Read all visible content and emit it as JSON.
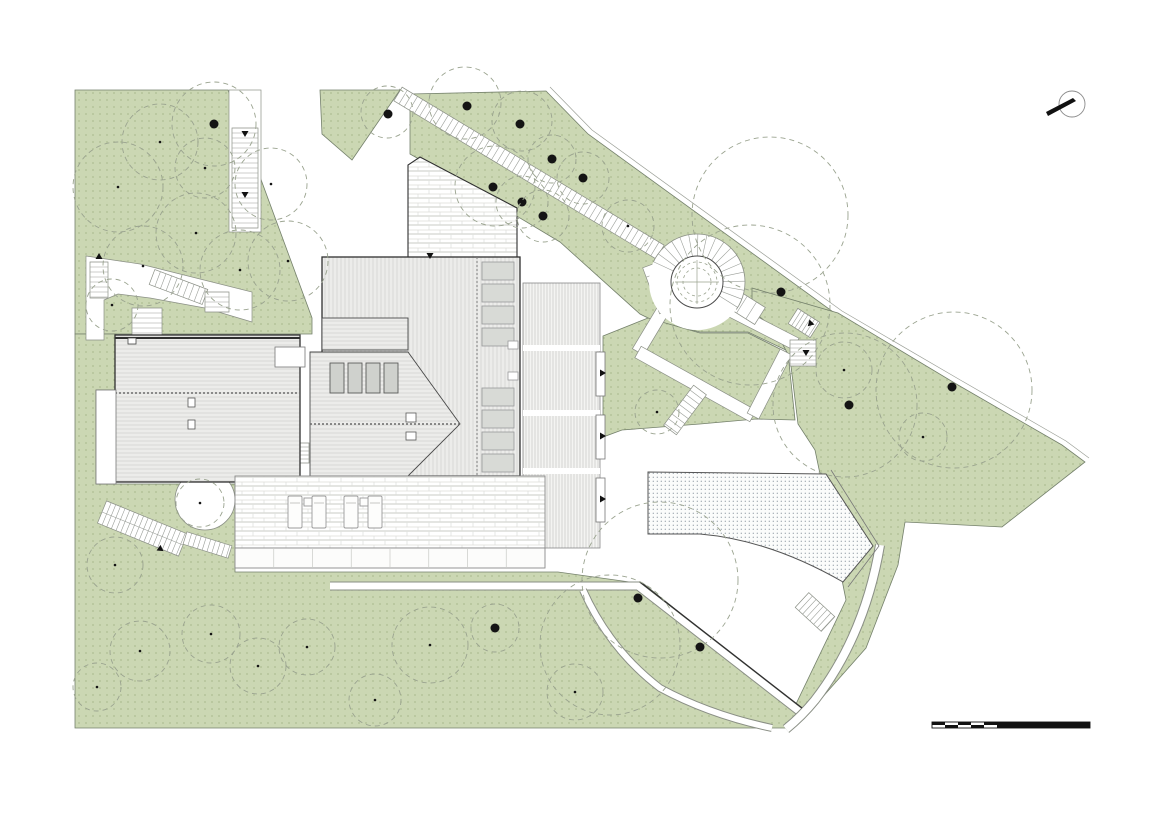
{
  "meta": {
    "drawing_type": "architectural-site-roof-plan",
    "visible_text": "none"
  },
  "canvas": {
    "width": 1160,
    "height": 821,
    "background": "#ffffff"
  },
  "colors": {
    "green_fill": "#cbd7b3",
    "green_dot": "#aebe93",
    "green_edge": "#74806b",
    "tree_dash": "#9aa38f",
    "trunk": "#141414",
    "roof_fill": "#ececea",
    "roof_line": "#d0d1cd",
    "outline_dark": "#2f2f2f",
    "skylight_fill": "#d8dad6",
    "skylight_edge": "#98989a",
    "brick_line": "#dcddd9",
    "path_edge": "#8a8f85",
    "tread": "#9a9e98",
    "stipple_dot": "#9aa3ac",
    "black": "#111111"
  },
  "north_arrow": {
    "cx": 1072,
    "cy": 104,
    "r": 13,
    "needle": [
      [
        1048,
        116
      ],
      [
        1076,
        101
      ],
      [
        1073,
        98
      ],
      [
        1046,
        112
      ]
    ]
  },
  "scale_bar": {
    "x": 932,
    "y": 722,
    "h": 6,
    "cell_w": 13,
    "cells": 5,
    "solid_w": 93
  },
  "greens": [
    [
      [
        75,
        90
      ],
      [
        228,
        90
      ],
      [
        312,
        318
      ],
      [
        312,
        334
      ],
      [
        96,
        334
      ],
      [
        75,
        334
      ]
    ],
    [
      [
        320,
        90
      ],
      [
        400,
        90
      ],
      [
        352,
        160
      ],
      [
        322,
        134
      ]
    ],
    [
      [
        410,
        94
      ],
      [
        546,
        91
      ],
      [
        588,
        134
      ],
      [
        836,
        314
      ],
      [
        814,
        332
      ],
      [
        790,
        352
      ],
      [
        748,
        332
      ],
      [
        700,
        332
      ],
      [
        652,
        320
      ],
      [
        640,
        314
      ],
      [
        560,
        242
      ],
      [
        470,
        188
      ],
      [
        410,
        154
      ]
    ],
    [
      [
        603,
        336
      ],
      [
        648,
        318
      ],
      [
        700,
        333
      ],
      [
        748,
        333
      ],
      [
        788,
        353
      ],
      [
        795,
        420
      ],
      [
        756,
        419
      ],
      [
        700,
        424
      ],
      [
        622,
        430
      ],
      [
        603,
        437
      ]
    ],
    [
      [
        752,
        288
      ],
      [
        838,
        313
      ],
      [
        958,
        385
      ],
      [
        1062,
        445
      ],
      [
        1085,
        462
      ],
      [
        1002,
        527
      ],
      [
        905,
        522
      ],
      [
        898,
        565
      ],
      [
        866,
        648
      ],
      [
        820,
        700
      ],
      [
        806,
        712
      ],
      [
        796,
        704
      ],
      [
        846,
        600
      ],
      [
        838,
        560
      ],
      [
        815,
        450
      ],
      [
        798,
        424
      ],
      [
        790,
        358
      ],
      [
        775,
        330
      ],
      [
        752,
        310
      ]
    ],
    [
      [
        75,
        334
      ],
      [
        116,
        334
      ],
      [
        116,
        390
      ],
      [
        96,
        390
      ],
      [
        96,
        484
      ],
      [
        116,
        484
      ],
      [
        235,
        484
      ],
      [
        235,
        572
      ],
      [
        558,
        572
      ],
      [
        644,
        584
      ],
      [
        806,
        714
      ],
      [
        788,
        728
      ],
      [
        75,
        728
      ]
    ]
  ],
  "boundary_offset_line": [
    [
      550,
      87
    ],
    [
      592,
      130
    ],
    [
      842,
      311
    ],
    [
      962,
      381
    ],
    [
      1066,
      441
    ],
    [
      1089,
      458
    ]
  ],
  "white_shapes": {
    "corridor_top": [
      229,
      90,
      32,
      142
    ],
    "winding_path": [
      [
        86,
        256
      ],
      [
        140,
        264
      ],
      [
        252,
        292
      ],
      [
        252,
        322
      ],
      [
        205,
        308
      ],
      [
        150,
        298
      ],
      [
        118,
        294
      ],
      [
        104,
        300
      ],
      [
        104,
        340
      ],
      [
        86,
        340
      ]
    ],
    "plaza_circle": [
      205,
      500,
      30
    ],
    "terrace_left_strip": [
      96,
      390,
      20,
      94
    ],
    "annex": [
      275,
      347,
      30,
      20
    ]
  },
  "corridor_bands": [
    {
      "a": [
        668,
        302
      ],
      "b": [
        638,
        352
      ],
      "w": 13
    },
    {
      "a": [
        638,
        352
      ],
      "b": [
        753,
        416
      ],
      "w": 13
    },
    {
      "a": [
        753,
        416
      ],
      "b": [
        786,
        352
      ],
      "w": 13
    },
    {
      "a": [
        718,
        304
      ],
      "b": [
        796,
        344
      ],
      "w": 13
    }
  ],
  "stairs": [
    {
      "a": [
        245,
        128
      ],
      "b": [
        245,
        228
      ],
      "w": 26,
      "step": 5
    },
    {
      "a": [
        99,
        262
      ],
      "b": [
        99,
        298
      ],
      "w": 18,
      "step": 5
    },
    {
      "a": [
        152,
        277
      ],
      "b": [
        205,
        297
      ],
      "w": 16,
      "step": 6
    },
    {
      "a": [
        147,
        308
      ],
      "b": [
        147,
        336
      ],
      "w": 30,
      "step": 5
    },
    {
      "a": [
        217,
        292
      ],
      "b": [
        217,
        312
      ],
      "w": 24,
      "step": 5
    },
    {
      "a": [
        102,
        512
      ],
      "b": [
        183,
        545
      ],
      "w": 24,
      "step": 5,
      "rail": true
    },
    {
      "a": [
        185,
        538
      ],
      "b": [
        230,
        552
      ],
      "w": 13,
      "step": 5
    },
    {
      "a": [
        653,
        264
      ],
      "b": [
        670,
        310
      ],
      "w": 22,
      "step": 10
    },
    {
      "a": [
        714,
        287
      ],
      "b": [
        760,
        316
      ],
      "w": 20,
      "step": 11
    },
    {
      "a": [
        793,
        316
      ],
      "b": [
        815,
        330
      ],
      "w": 18,
      "step": 4
    },
    {
      "a": [
        803,
        340
      ],
      "b": [
        803,
        366
      ],
      "w": 26,
      "step": 4
    },
    {
      "a": [
        802,
        600
      ],
      "b": [
        828,
        624
      ],
      "w": 20,
      "step": 5
    },
    {
      "a": [
        700,
        390
      ],
      "b": [
        670,
        430
      ],
      "w": 16,
      "step": 6
    },
    {
      "a": [
        398,
        94
      ],
      "b": [
        660,
        252
      ],
      "w": 16,
      "step": 6
    },
    {
      "a": [
        302,
        443
      ],
      "b": [
        302,
        463
      ],
      "w": 14,
      "step": 4
    }
  ],
  "routes": [
    {
      "d": "M330,586 L638,586 L800,712",
      "w": 7
    },
    {
      "d": "M583,590 Q610,650 660,688 Q710,715 772,728",
      "w": 6
    },
    {
      "d": "M880,545 Q865,635 815,700 Q802,716 786,729",
      "w": 8
    }
  ],
  "route_dark_edge": "M640,582 L802,708",
  "spiral_stair": {
    "cx": 697,
    "cy": 282,
    "r_plaza": 48,
    "r_outer": 26,
    "r_dashed": [
      20,
      14
    ],
    "fan": {
      "r1": 26,
      "r2": 48,
      "a1": -155,
      "a2": 35,
      "step": 11
    }
  },
  "buildings": {
    "left": {
      "rect": [
        115,
        335,
        185,
        147
      ],
      "ridge_y": 393,
      "chimney": [
        128,
        338,
        8,
        6
      ],
      "vents": [
        [
          188,
          398,
          7,
          9
        ],
        [
          188,
          420,
          7,
          9
        ]
      ]
    },
    "main_roof": {
      "rect": [
        322,
        257,
        198,
        219
      ],
      "divider_x": 477
    },
    "courtyard": [
      [
        408,
        257
      ],
      [
        408,
        165
      ],
      [
        420,
        157
      ],
      [
        517,
        208
      ],
      [
        517,
        257
      ]
    ],
    "skylights": {
      "x": 482,
      "w": 32,
      "h": 18,
      "ys": [
        262,
        284,
        306,
        328,
        388,
        410,
        432,
        454
      ],
      "small": [
        [
          508,
          341,
          10,
          8
        ],
        [
          508,
          372,
          10,
          8
        ]
      ]
    },
    "wing": [
      322,
      318,
      86,
      32
    ],
    "hip": {
      "poly": [
        [
          310,
          352
        ],
        [
          408,
          352
        ],
        [
          460,
          424
        ],
        [
          408,
          476
        ],
        [
          310,
          476
        ]
      ],
      "ridge": [
        310,
        424,
        460,
        424
      ],
      "windows": {
        "xs": [
          330,
          348,
          366,
          384
        ],
        "y": 363,
        "w": 14,
        "h": 30
      },
      "vents": [
        [
          406,
          413,
          10,
          9
        ],
        [
          406,
          432,
          10,
          8
        ]
      ]
    },
    "striped_zone": {
      "rect": [
        523,
        283,
        77,
        265
      ],
      "gaps": [
        345,
        410,
        468
      ],
      "doors": [
        [
          596,
          352,
          9,
          44
        ],
        [
          596,
          415,
          9,
          44
        ],
        [
          596,
          478,
          9,
          44
        ]
      ]
    },
    "terrace": {
      "rect": [
        235,
        476,
        310,
        72
      ],
      "loungers": [
        [
          288,
          496
        ],
        [
          312,
          496
        ],
        [
          344,
          496
        ],
        [
          368,
          496
        ]
      ],
      "lounger_size": [
        14,
        32
      ],
      "tables": [
        [
          304,
          498
        ],
        [
          360,
          498
        ]
      ],
      "step_band": {
        "y": 548,
        "h": 20,
        "cols": 8
      }
    }
  },
  "pool": {
    "outline": "M648,472 L826,474 L873,546 L843,582 Q770,540 700,534 L648,534 Z",
    "deck_edge": "M831,470 L879,546 L848,587"
  },
  "trees": [
    [
      118,
      187,
      45,
      "s"
    ],
    [
      160,
      142,
      38,
      "s"
    ],
    [
      214,
      124,
      42,
      "b"
    ],
    [
      205,
      168,
      30,
      "s"
    ],
    [
      271,
      184,
      36,
      "s"
    ],
    [
      288,
      261,
      40,
      "s"
    ],
    [
      196,
      233,
      40,
      "s"
    ],
    [
      143,
      266,
      40,
      "s"
    ],
    [
      112,
      305,
      26,
      "s"
    ],
    [
      240,
      270,
      40,
      "s"
    ],
    [
      387,
      112,
      26,
      "n"
    ],
    [
      388,
      114,
      0,
      "b"
    ],
    [
      465,
      103,
      36,
      "n"
    ],
    [
      467,
      106,
      0,
      "b"
    ],
    [
      522,
      121,
      30,
      "n"
    ],
    [
      520,
      124,
      0,
      "b"
    ],
    [
      552,
      159,
      24,
      "b"
    ],
    [
      583,
      178,
      26,
      "b"
    ],
    [
      495,
      186,
      40,
      "n"
    ],
    [
      493,
      187,
      0,
      "b"
    ],
    [
      522,
      202,
      26,
      "b"
    ],
    [
      543,
      216,
      26,
      "b"
    ],
    [
      628,
      226,
      26,
      "s"
    ],
    [
      770,
      215,
      78,
      "n"
    ],
    [
      781,
      292,
      0,
      "b"
    ],
    [
      750,
      305,
      80,
      "n"
    ],
    [
      657,
      412,
      22,
      "s"
    ],
    [
      845,
      405,
      72,
      "n"
    ],
    [
      849,
      405,
      0,
      "b"
    ],
    [
      954,
      390,
      78,
      "n"
    ],
    [
      952,
      387,
      0,
      "b"
    ],
    [
      844,
      370,
      28,
      "s"
    ],
    [
      923,
      437,
      24,
      "s"
    ],
    [
      660,
      580,
      78,
      "n"
    ],
    [
      610,
      645,
      70,
      "n"
    ],
    [
      638,
      598,
      0,
      "b"
    ],
    [
      700,
      647,
      0,
      "b"
    ],
    [
      495,
      628,
      24,
      "b"
    ],
    [
      430,
      645,
      38,
      "s"
    ],
    [
      575,
      692,
      28,
      "s"
    ],
    [
      115,
      565,
      28,
      "s"
    ],
    [
      140,
      651,
      30,
      "s"
    ],
    [
      211,
      634,
      29,
      "s"
    ],
    [
      258,
      666,
      28,
      "s"
    ],
    [
      307,
      647,
      28,
      "s"
    ],
    [
      375,
      700,
      26,
      "s"
    ],
    [
      200,
      503,
      24,
      "s"
    ],
    [
      97,
      687,
      24,
      "s"
    ]
  ],
  "arrows": [
    [
      245,
      131,
      90
    ],
    [
      245,
      192,
      90
    ],
    [
      99,
      259,
      -90
    ],
    [
      162,
      548,
      155
    ],
    [
      600,
      373,
      0
    ],
    [
      600,
      436,
      0
    ],
    [
      600,
      499,
      0
    ],
    [
      430,
      253,
      90
    ],
    [
      812,
      322,
      135
    ],
    [
      806,
      350,
      90
    ]
  ]
}
